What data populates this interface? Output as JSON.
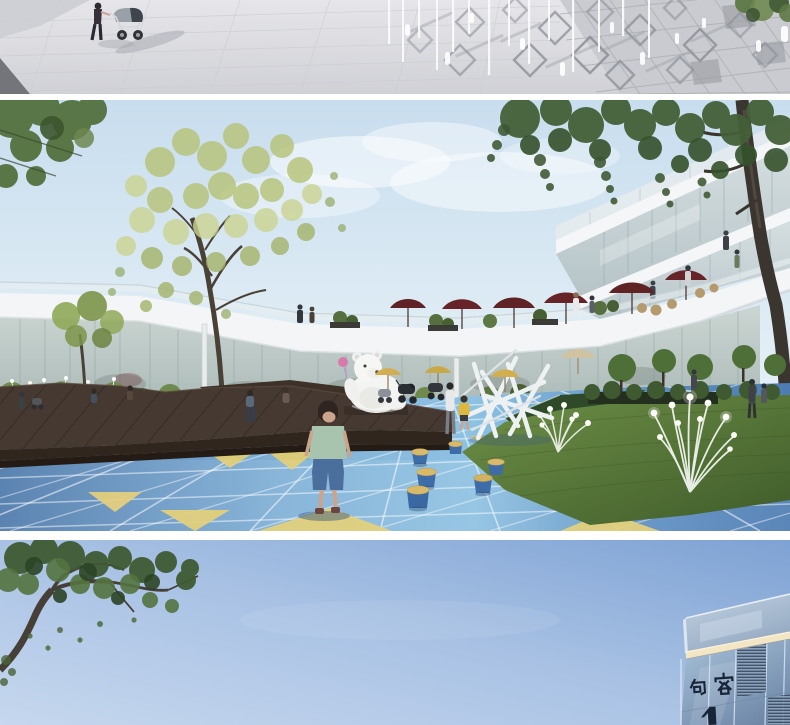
{
  "bottom_image": {
    "building_sign": "句容",
    "building_sign_partial": "1"
  },
  "colors": {
    "plaza_paving_gray": "#d6d7db",
    "courtyard_sky_blue": "#cfe2ef",
    "playground_floor_blue": "#5b8fc4",
    "accent_tile_yellow": "#e3cd70",
    "terrace_umbrella_maroon": "#5f2326",
    "lawn_green": "#4e6f35",
    "deck_wood_brown": "#3a2f26",
    "building_white": "#f3f5f6",
    "evening_sky_blue": "#84a6d8",
    "facade_glass_blue": "#9db8d4",
    "sign_text_navy": "#182538"
  }
}
